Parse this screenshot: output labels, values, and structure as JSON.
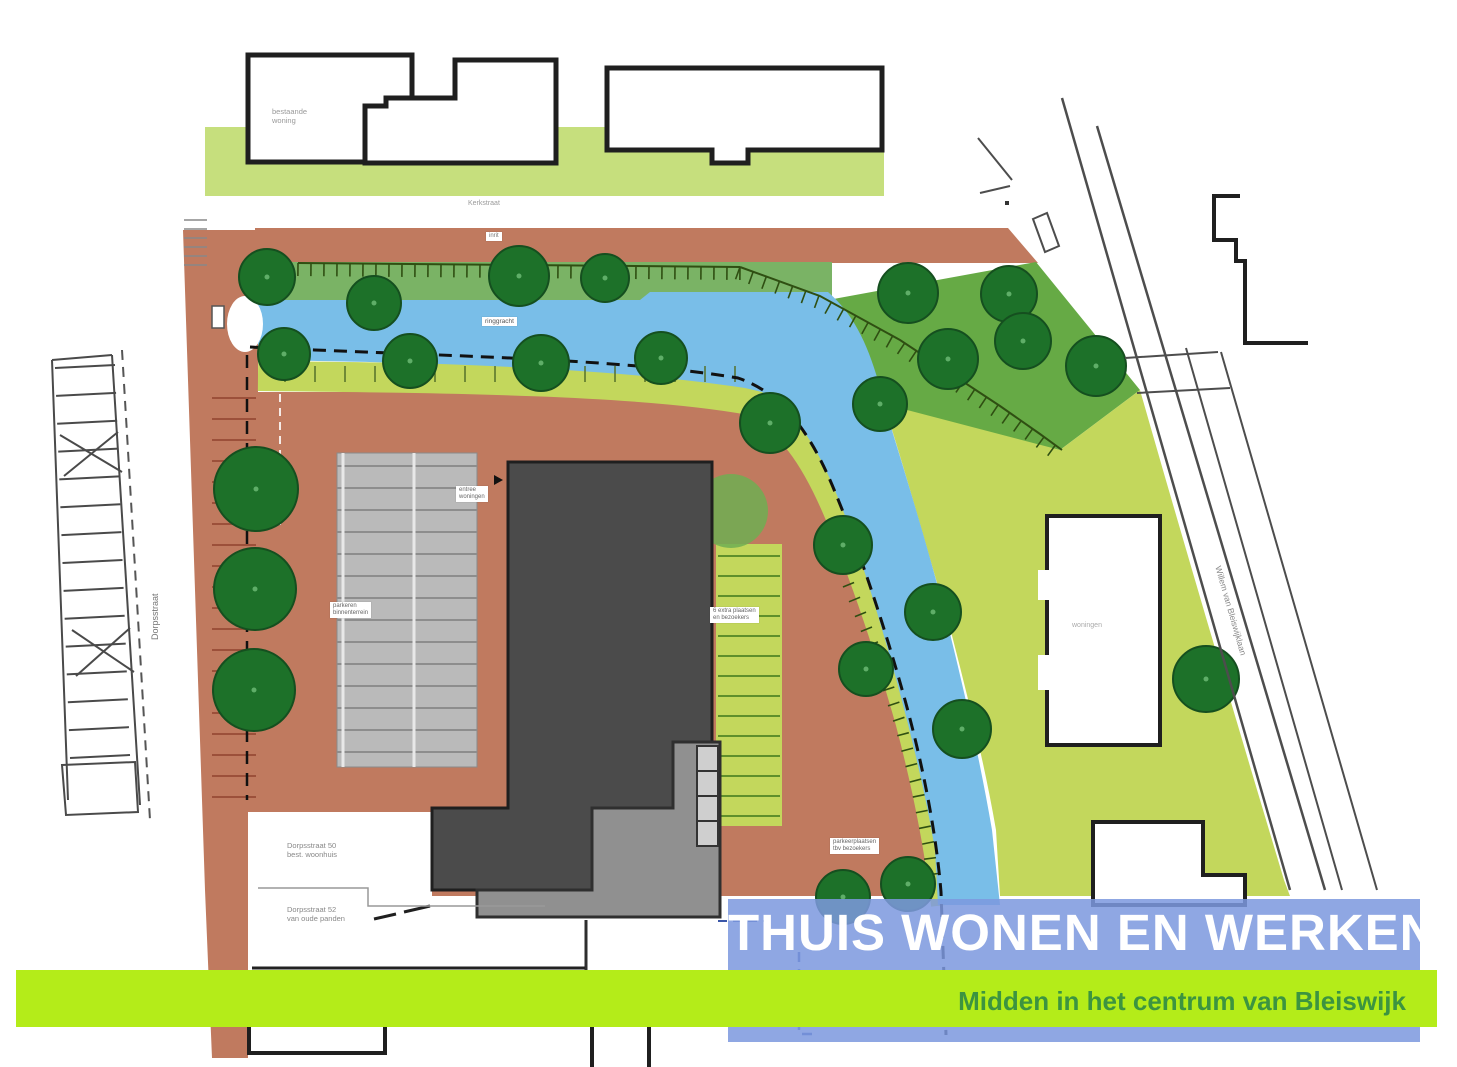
{
  "banner": {
    "title": "THUIS WONEN EN WERKEN",
    "subtitle": "Midden in het centrum van Bleiswijk",
    "title_bg": "#7d98de",
    "title_color": "#ffffff",
    "subtitle_bar_bg": "#b4ec19",
    "subtitle_color": "#3c9440"
  },
  "map": {
    "colors": {
      "terracotta": "#c07a5f",
      "terracotta_tick": "#9c503a",
      "water": "#79bee8",
      "green_strip_top": "#c6df7d",
      "green_bank": "#7ab365",
      "green_dark_area": "#66aa45",
      "yellow_green": "#c3d75c",
      "tree_fill": "#1d7129",
      "tree_stroke": "#154f1f",
      "tree_dot": "#5fae68",
      "building_dark": "#4b4b4b",
      "building_mid": "#909090",
      "parking_gray": "#bababa",
      "outline_black": "#1f1f1f",
      "street_line": "#4d4d4d",
      "hatch_green": "#2f4f12"
    },
    "trees": [
      [
        267,
        277,
        28
      ],
      [
        374,
        303,
        27
      ],
      [
        519,
        276,
        30
      ],
      [
        605,
        278,
        24
      ],
      [
        908,
        293,
        30
      ],
      [
        1009,
        294,
        28
      ],
      [
        1023,
        341,
        28
      ],
      [
        948,
        359,
        30
      ],
      [
        1096,
        366,
        30
      ],
      [
        880,
        404,
        27
      ],
      [
        284,
        354,
        26
      ],
      [
        410,
        361,
        27
      ],
      [
        541,
        363,
        28
      ],
      [
        661,
        358,
        26
      ],
      [
        770,
        423,
        30
      ],
      [
        843,
        545,
        29
      ],
      [
        933,
        612,
        28
      ],
      [
        866,
        669,
        27
      ],
      [
        962,
        729,
        29
      ],
      [
        843,
        897,
        27
      ],
      [
        908,
        884,
        27
      ],
      [
        256,
        489,
        42
      ],
      [
        255,
        589,
        41
      ],
      [
        254,
        690,
        41
      ],
      [
        1206,
        679,
        33
      ]
    ],
    "pale_tree": [
      731,
      511,
      37
    ],
    "labels": [
      {
        "name": "label-existing-house",
        "x": 272,
        "y": 108,
        "size": 7.5,
        "color": "#999999",
        "lines": [
          "bestaande",
          "woning"
        ]
      },
      {
        "name": "street-label-top",
        "x": 468,
        "y": 200,
        "size": 7,
        "color": "#9a9a9a",
        "lines": [
          "Kerkstraat"
        ]
      },
      {
        "name": "label-inrit",
        "x": 486,
        "y": 232,
        "size": 6,
        "color": "#777777",
        "boxed": true,
        "lines": [
          "inrit"
        ]
      },
      {
        "name": "label-gracht",
        "x": 482,
        "y": 317,
        "size": 6.5,
        "color": "#555555",
        "boxed": true,
        "lines": [
          "ringgracht"
        ]
      },
      {
        "name": "label-entree",
        "x": 456,
        "y": 486,
        "size": 6,
        "color": "#666666",
        "boxed": true,
        "lines": [
          "entree",
          "woningen"
        ]
      },
      {
        "name": "label-parkeren-binnenhof",
        "x": 330,
        "y": 602,
        "size": 6,
        "color": "#666666",
        "boxed": true,
        "lines": [
          "parkeren",
          "binnenterrein"
        ]
      },
      {
        "name": "label-extra-plaatsen",
        "x": 710,
        "y": 607,
        "size": 6,
        "color": "#666666",
        "boxed": true,
        "lines": [
          "6 extra plaatsen",
          "en bezoekers"
        ]
      },
      {
        "name": "label-parkeerplaatsen-bezoekers",
        "x": 830,
        "y": 838,
        "size": 6,
        "color": "#666666",
        "boxed": true,
        "lines": [
          "parkeerplaatsen",
          "tbv bezoekers"
        ]
      },
      {
        "name": "label-woningen",
        "x": 1072,
        "y": 622,
        "size": 7,
        "color": "#aaaaaa",
        "lines": [
          "woningen"
        ]
      },
      {
        "name": "label-dorpsstraat-50",
        "x": 287,
        "y": 842,
        "size": 7.5,
        "color": "#888888",
        "lines": [
          "Dorpsstraat 50",
          "best. woonhuis"
        ]
      },
      {
        "name": "label-dorpsstraat-52",
        "x": 287,
        "y": 906,
        "size": 7.5,
        "color": "#888888",
        "lines": [
          "Dorpsstraat 52",
          "van oude panden"
        ]
      },
      {
        "name": "street-label-left",
        "x": 150,
        "y": 640,
        "size": 9,
        "color": "#777777",
        "rot": -90,
        "lines": [
          "Dorpsstraat"
        ]
      },
      {
        "name": "street-label-right",
        "x": 1222,
        "y": 565,
        "size": 8.5,
        "color": "#888888",
        "rot": 74,
        "lines": [
          "Willem van Bleiswijklaan"
        ]
      }
    ]
  }
}
